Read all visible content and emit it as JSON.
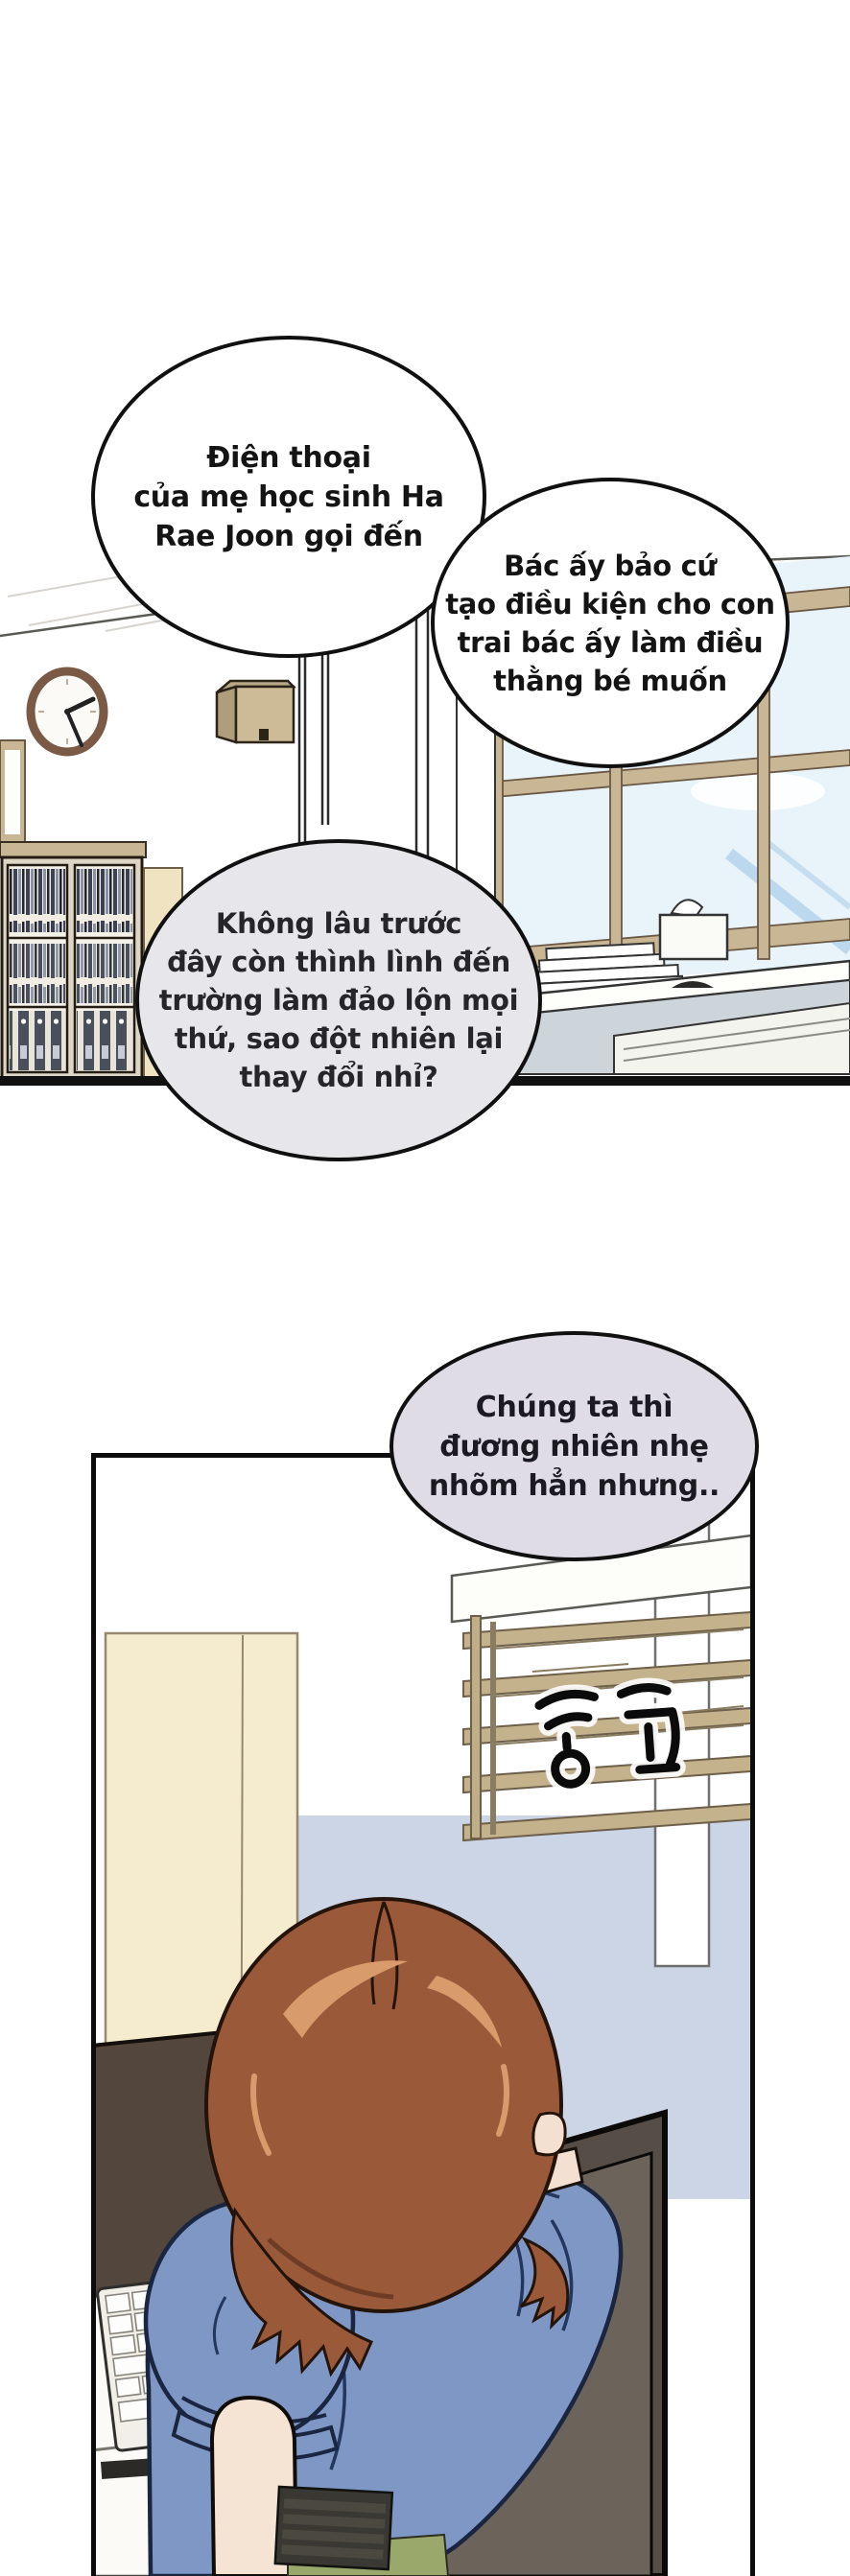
{
  "speech_bubbles": [
    {
      "id": "bubble-1",
      "fill": "#ffffff",
      "lines": [
        "Điện thoại",
        "của mẹ học sinh Ha",
        "Rae Joon gọi đến"
      ]
    },
    {
      "id": "bubble-2",
      "fill": "#ffffff",
      "lines": [
        "Bác ấy bảo cứ",
        "tạo điều kiện cho con",
        "trai bác ấy làm điều",
        "thằng bé muốn"
      ]
    },
    {
      "id": "bubble-3",
      "fill": "#e7e6ea",
      "lines": [
        "Không lâu trước",
        "đây còn thình lình đến",
        "trường làm đảo lộn mọi",
        "thứ, sao đột nhiên lại",
        "thay đổi nhỉ?"
      ]
    },
    {
      "id": "bubble-4",
      "fill": "#dfdce6",
      "lines": [
        "Chúng ta thì",
        "đương nhiên nhẹ",
        "nhõm hẳn nhưng.."
      ]
    }
  ],
  "signature_text": "종국",
  "scene_objects": {
    "office": [
      "wall-clock",
      "wall-speaker",
      "bookshelf-with-books",
      "binder-shelf",
      "windows-with-sky",
      "office-desks",
      "paper-stacks",
      "tissue-box"
    ],
    "desk_panel": [
      "cream-cabinet",
      "window-blinds",
      "wall-column",
      "korean-signature",
      "monitor-back",
      "white-keyboard",
      "small-monitor",
      "woman-from-behind",
      "office-chair",
      "dark-keyboard",
      "green-mat"
    ]
  },
  "palette": {
    "ink": "#111111",
    "bubble_gray": "#e7e6ea",
    "bubble_lavender": "#dfdce6",
    "hair_brown": "#9a5a3a",
    "hair_highlight": "#d89b6b",
    "blouse_blue": "#7e97c5",
    "blouse_line": "#1a2540",
    "skin": "#f5e3d4",
    "chair_dark": "#554d46",
    "chair_inner": "#6c635a",
    "wood_tan": "#c9b694",
    "sky_blue": "#e8f3fa",
    "wall_periwinkle": "#ccd5e6",
    "wall_gray": "#b1b7af",
    "cabinet_cream": "#f5ecd0",
    "monitor_brown": "#53463c",
    "green_mat": "#9aa96b"
  }
}
